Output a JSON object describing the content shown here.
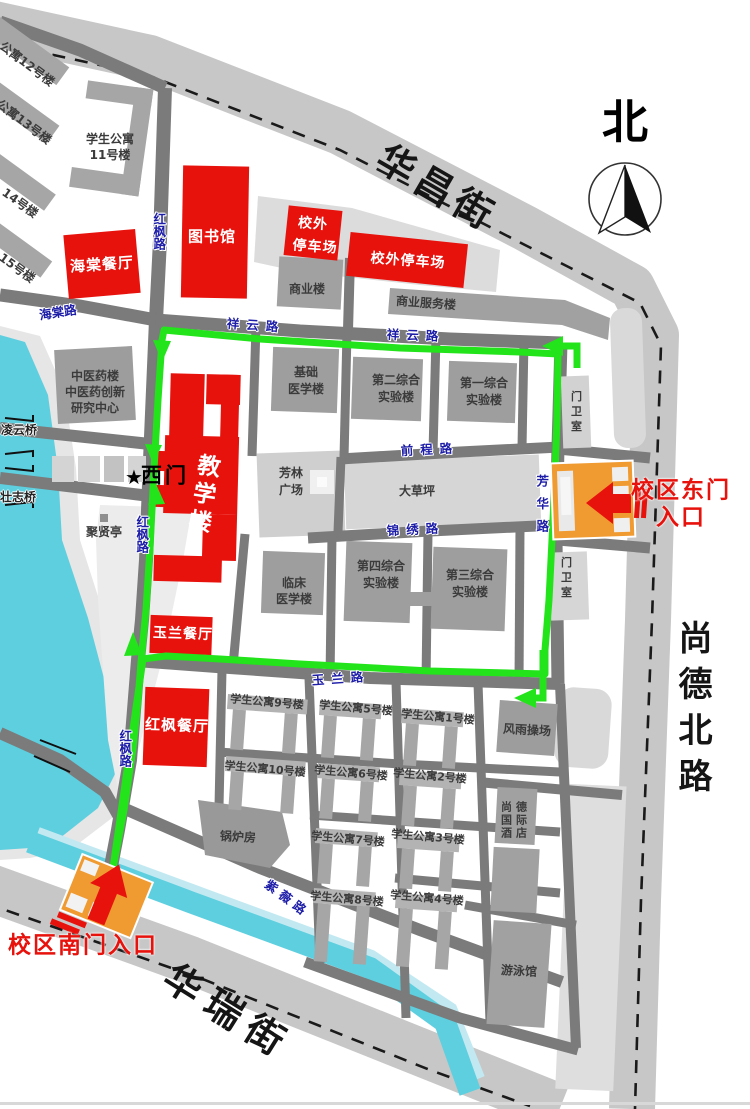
{
  "compass": {
    "north": "北"
  },
  "streets": {
    "huachang": "华昌街",
    "huarui": "华瑞街",
    "shangdebeilu": "尚德北路"
  },
  "roads": {
    "haitang": "海棠路",
    "hongfeng": "红枫路",
    "xiangyun": "祥云路",
    "qiancheng": "前程路",
    "jinxiu": "锦绣路",
    "fanghua": "芳华路",
    "yulan": "玉兰路",
    "ziwei": "紫薇路"
  },
  "gates": {
    "east": {
      "line1": "校区东门",
      "line2": "入口"
    },
    "south": {
      "label": "校区南门入口"
    },
    "west": {
      "star": "★",
      "label": "西门"
    }
  },
  "bridges": {
    "lingyun": "凌云桥",
    "zhuangzhi": "壮志桥"
  },
  "places": {
    "haitang_canteen": "海棠餐厅",
    "library": "图书馆",
    "parking_small": {
      "lines": [
        "校外",
        "停车场"
      ]
    },
    "parking_wide": "校外停车场",
    "shangye": "商业楼",
    "shangye_fuwu": "商业服务楼",
    "dorm11": {
      "lines": [
        "学生公寓",
        "11号楼"
      ]
    },
    "dorm12": "公寓12号楼",
    "dorm13": "公寓13号楼",
    "dorm14": "14号楼",
    "dorm15": "15号楼",
    "zhongyiyao": {
      "lines": [
        "中医药楼",
        "中医药创新",
        "研究中心"
      ]
    },
    "teaching": "教学楼",
    "jichu": {
      "lines": [
        "基础",
        "医学楼"
      ]
    },
    "dier": {
      "lines": [
        "第二综合",
        "实验楼"
      ]
    },
    "diyi": {
      "lines": [
        "第一综合",
        "实验楼"
      ]
    },
    "menweishi": "门卫室",
    "fanglin": {
      "lines": [
        "芳林",
        "广场"
      ]
    },
    "dacaoping": "大草坪",
    "linchuang": {
      "lines": [
        "临床",
        "医学楼"
      ]
    },
    "disi": {
      "lines": [
        "第四综合",
        "实验楼"
      ]
    },
    "disan": {
      "lines": [
        "第三综合",
        "实验楼"
      ]
    },
    "juxianting": "聚贤亭",
    "yulan_canteen": "玉兰餐厅",
    "hongfeng_canteen": "红枫餐厅",
    "apt9": "学生公寓9号楼",
    "apt5": "学生公寓5号楼",
    "apt1": "学生公寓1号楼",
    "apt10": "学生公寓10号楼",
    "apt6": "学生公寓6号楼",
    "apt2": "学生公寓2号楼",
    "guolufang": "锅炉房",
    "apt7": "学生公寓7号楼",
    "apt3": "学生公寓3号楼",
    "apt8": "学生公寓8号楼",
    "apt4": "学生公寓4号楼",
    "fengyu": "风雨操场",
    "hotel": {
      "lines": [
        "尚德",
        "国际",
        "酒店"
      ]
    },
    "natatorium": "游泳馆"
  },
  "colors": {
    "red": "#e8120d",
    "orange": "#f09a32",
    "green": "#23e31b",
    "water": "#5ecfdf",
    "road_dark": "#7b7b7b",
    "road_light": "#c7c7c7",
    "building_gray": "#a6a6a6",
    "light_gray": "#dadada",
    "label_blue": "#1d1da8",
    "gate_red": "#e8120d"
  }
}
